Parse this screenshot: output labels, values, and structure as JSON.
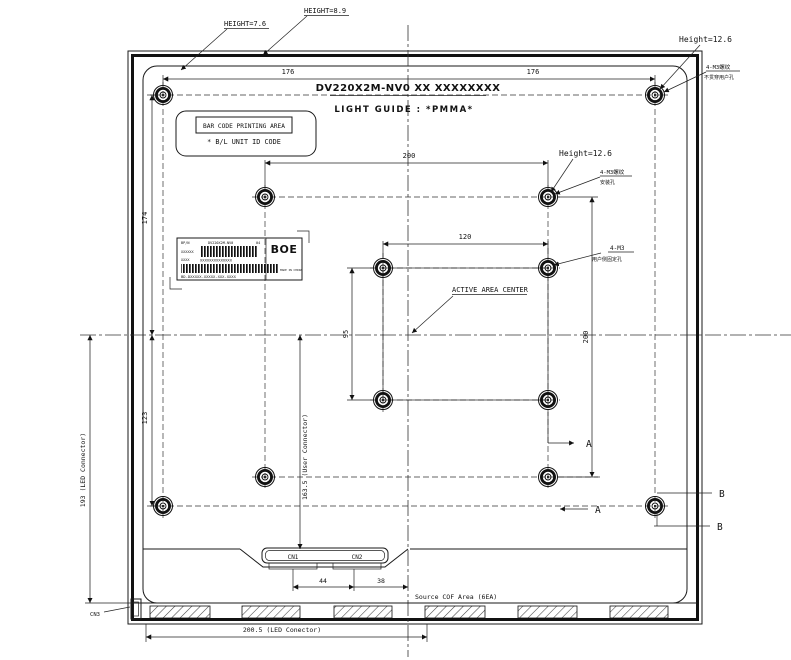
{
  "header": {
    "part_number_line": "DV220X2M-NV0 XX XXXXXXXX",
    "material_line": "LIGHT GUIDE : *PMMA*"
  },
  "callouts": {
    "height_top_left": "HEIGHT=7.6",
    "height_top_mid": "HEIGHT=8.9",
    "height_corner": "Height=12.6",
    "height_inner": "Height=12.6",
    "corner_screw_line1": "4-M3螺纹",
    "corner_screw_line2": "不贯穿用户孔",
    "inner_screw_line1": "4-M3螺纹",
    "inner_screw_line2": "安装孔",
    "user_screw_line1": "4-M3",
    "user_screw_line2": "用户侧固定孔",
    "active_area_center": "ACTIVE AREA CENTER"
  },
  "barcode_area": {
    "title": "BAR CODE PRINTING AREA",
    "subtitle": "* B/L UNIT ID CODE"
  },
  "id_label": {
    "field1": "BP/N",
    "part": "DV220X2M-NV0",
    "rev": "04",
    "serial": "XXXXXX",
    "serial2": "XXXX",
    "digits": "XXXXXXXXXXXXXX",
    "brand": "BOE",
    "origin": "MADE IN CHINA",
    "code": "BD-DXXXXX-XXXXX-XXX-XXXX"
  },
  "dimensions": {
    "d176_left": "176",
    "d176_right": "176",
    "d200_top": "200",
    "d120": "120",
    "d174": "174",
    "d123": "123",
    "d200_right": "200",
    "d95": "95",
    "d44": "44",
    "d38": "38",
    "d193": "193 (LED Connector)",
    "d163_5": "163.5 (User Connector)",
    "d200_5": "200.5 (LED Conector)"
  },
  "connectors": {
    "cn1": "CN1",
    "cn2": "CN2",
    "cn3": "CN3"
  },
  "notes": {
    "source_cof": "Source COF Area (6EA)"
  },
  "sections": {
    "a1": "A",
    "a2": "A",
    "b1": "B",
    "b2": "B"
  }
}
